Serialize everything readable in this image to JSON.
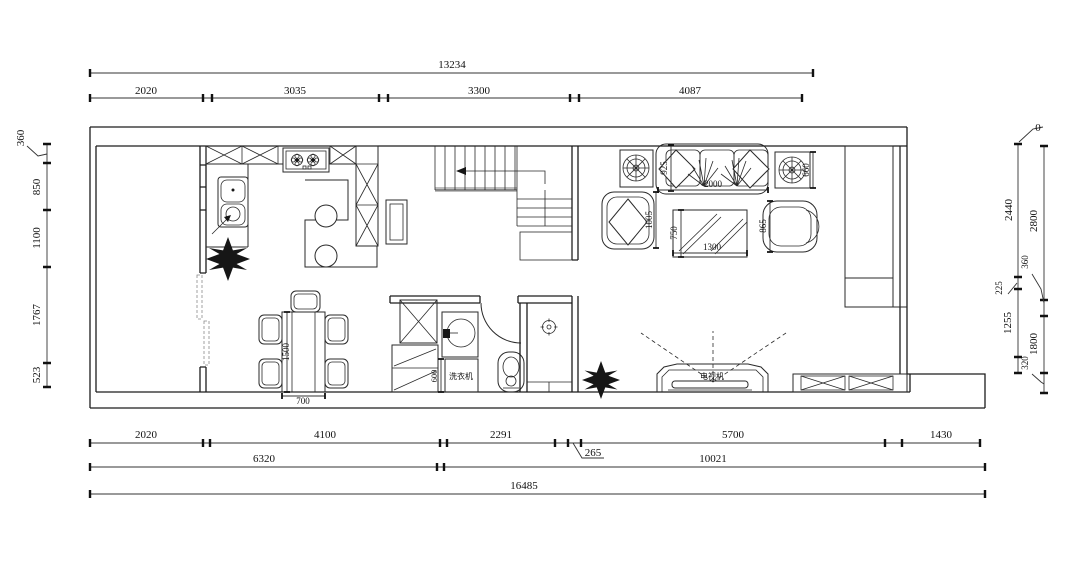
{
  "dims": {
    "top_overall": "13234",
    "top": [
      "2020",
      "3035",
      "3300",
      "4087"
    ],
    "bottom1": [
      "2020",
      "4100",
      "2291",
      "265",
      "5700",
      "1430"
    ],
    "bottom2": [
      "6320",
      "10021"
    ],
    "bottom3": "16485",
    "left": [
      "360",
      "850",
      "1100",
      "1767",
      "523"
    ],
    "right_inner": [
      "0",
      "2440",
      "225",
      "1255"
    ],
    "right_outer": [
      "2800",
      "360",
      "1800",
      "320"
    ]
  },
  "furniture": {
    "sofa_width": "2000",
    "sofa_depth": "925",
    "armchair_left": "1005",
    "armchair_right": "865",
    "side_table": "660",
    "coffee_table_width": "1300",
    "coffee_table_depth": "750",
    "dining_table_length": "1500",
    "dining_table_width": "700",
    "laundry_counter": "600",
    "washing_machine": "洗衣机",
    "tv": "电视机"
  }
}
